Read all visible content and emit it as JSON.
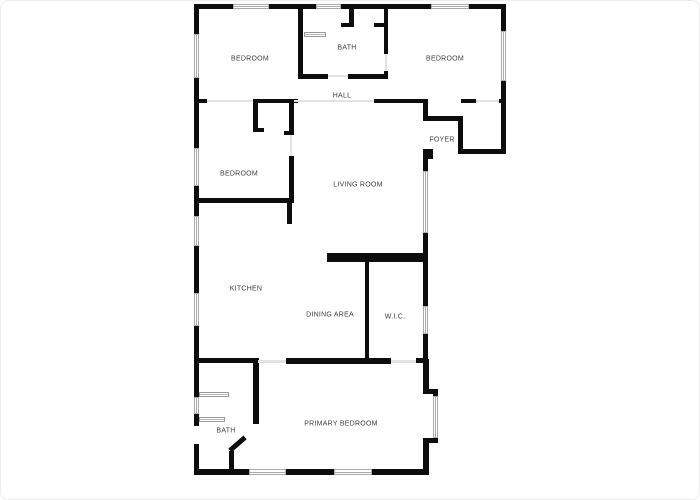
{
  "page": {
    "background": "#ffffff",
    "type_note": "residential floor plan drawing"
  },
  "plan": {
    "wall_color": "#0d0d0d",
    "label_color": "#3c3c3c",
    "window_line_color": "#ababab",
    "opening_line_color": "#e2e2e2",
    "walls": [
      [
        193,
        3,
        312,
        5
      ],
      [
        193,
        3,
        5,
        471
      ],
      [
        500,
        3,
        5,
        150
      ],
      [
        457,
        148,
        48,
        5
      ],
      [
        425,
        148,
        7,
        10
      ],
      [
        422,
        148,
        5,
        214
      ],
      [
        193,
        468,
        235,
        6
      ],
      [
        422,
        358,
        6,
        33
      ],
      [
        422,
        388,
        15,
        5
      ],
      [
        432,
        390,
        5,
        52
      ],
      [
        422,
        437,
        15,
        5
      ],
      [
        422,
        440,
        6,
        30
      ],
      [
        297,
        8,
        5,
        69
      ],
      [
        297,
        73,
        30,
        5
      ],
      [
        347,
        73,
        40,
        5
      ],
      [
        348,
        8,
        5,
        18
      ],
      [
        340,
        22,
        13,
        4
      ],
      [
        373,
        22,
        14,
        4
      ],
      [
        383,
        8,
        4,
        45
      ],
      [
        383,
        70,
        4,
        8
      ],
      [
        193,
        98,
        13,
        4
      ],
      [
        252,
        98,
        45,
        4
      ],
      [
        373,
        98,
        54,
        4
      ],
      [
        460,
        98,
        15,
        4
      ],
      [
        498,
        98,
        7,
        4
      ],
      [
        252,
        102,
        5,
        29
      ],
      [
        252,
        127,
        11,
        4
      ],
      [
        288,
        102,
        5,
        32
      ],
      [
        283,
        130,
        10,
        4
      ],
      [
        288,
        155,
        5,
        47
      ],
      [
        196,
        197,
        97,
        5
      ],
      [
        286,
        202,
        5,
        21
      ],
      [
        422,
        102,
        5,
        18
      ],
      [
        422,
        115,
        38,
        5
      ],
      [
        457,
        115,
        5,
        36
      ],
      [
        326,
        252,
        101,
        9
      ],
      [
        364,
        261,
        4,
        97
      ],
      [
        193,
        357,
        64,
        5
      ],
      [
        285,
        357,
        105,
        6
      ],
      [
        415,
        357,
        12,
        5
      ],
      [
        252,
        357,
        6,
        66
      ],
      [
        228,
        450,
        5,
        22
      ]
    ],
    "diagonal_walls": [
      {
        "x": 229,
        "y": 447,
        "len": 20,
        "thick": 5,
        "angle": -41
      }
    ],
    "windows_h": [
      [
        232,
        3,
        36,
        5
      ],
      [
        315,
        3,
        25,
        5
      ],
      [
        430,
        3,
        38,
        5
      ],
      [
        248,
        468,
        37,
        6
      ],
      [
        333,
        468,
        38,
        6
      ]
    ],
    "windows_v": [
      [
        193,
        33,
        5,
        44
      ],
      [
        193,
        147,
        5,
        38
      ],
      [
        193,
        215,
        5,
        30
      ],
      [
        193,
        292,
        5,
        33
      ],
      [
        193,
        396,
        5,
        17
      ],
      [
        500,
        30,
        5,
        50
      ],
      [
        422,
        170,
        5,
        62
      ],
      [
        422,
        305,
        5,
        28
      ],
      [
        432,
        395,
        5,
        42
      ]
    ],
    "gaps": [
      [
        193,
        425,
        5,
        18
      ]
    ],
    "openings": [
      [
        206,
        99,
        46,
        2
      ],
      [
        293,
        99,
        80,
        2
      ],
      [
        475,
        99,
        23,
        2
      ],
      [
        327,
        74,
        20,
        2
      ],
      [
        289,
        134,
        2,
        21
      ],
      [
        384,
        53,
        2,
        17
      ],
      [
        257,
        359,
        28,
        3
      ],
      [
        390,
        359,
        25,
        3
      ]
    ],
    "fixtures": [
      [
        303,
        31,
        22,
        5
      ],
      [
        198,
        391,
        30,
        5
      ],
      [
        198,
        416,
        26,
        5
      ]
    ],
    "rooms": [
      {
        "id": "bedroom-top-left",
        "label": "BEDROOM",
        "x": 249,
        "y": 58
      },
      {
        "id": "bath-top",
        "label": "BATH",
        "x": 346,
        "y": 47
      },
      {
        "id": "bedroom-top-right",
        "label": "BEDROOM",
        "x": 444,
        "y": 58
      },
      {
        "id": "hall",
        "label": "HALL",
        "x": 341,
        "y": 95
      },
      {
        "id": "foyer",
        "label": "FOYER",
        "x": 441,
        "y": 139
      },
      {
        "id": "bedroom-mid-left",
        "label": "BEDROOM",
        "x": 238,
        "y": 173
      },
      {
        "id": "living-room",
        "label": "LIVING ROOM",
        "x": 357,
        "y": 184
      },
      {
        "id": "kitchen",
        "label": "KITCHEN",
        "x": 245,
        "y": 288
      },
      {
        "id": "dining-area",
        "label": "DINING AREA",
        "x": 329,
        "y": 314
      },
      {
        "id": "wic",
        "label": "W.I.C.",
        "x": 394,
        "y": 316
      },
      {
        "id": "bath-bottom",
        "label": "BATH",
        "x": 225,
        "y": 430
      },
      {
        "id": "primary-bedroom",
        "label": "PRIMARY BEDROOM",
        "x": 340,
        "y": 423
      }
    ]
  }
}
